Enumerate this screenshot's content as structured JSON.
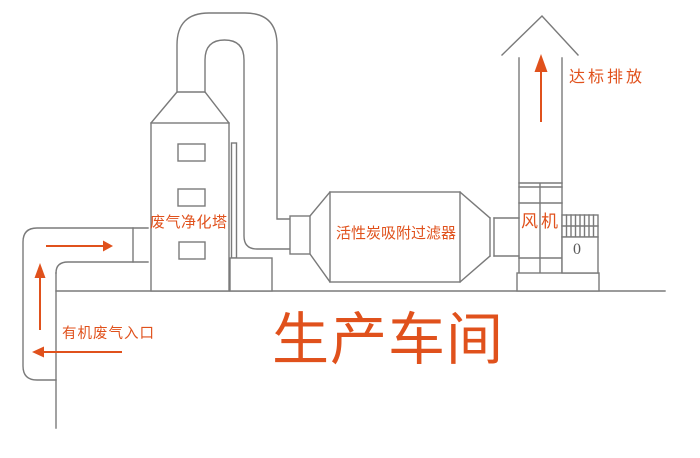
{
  "diagram": {
    "type": "waste-gas-treatment-process-flow",
    "workshop_title": "生产车间",
    "labels": {
      "tower": "废气净化塔",
      "filter": "活性炭吸附过滤器",
      "fan": "风机",
      "emission": "达标排放",
      "inlet": "有机废气入口",
      "motor_mark": "0"
    },
    "colors": {
      "line": "#7a7a7a",
      "accent": "#e0511c",
      "background": "#ffffff"
    }
  }
}
